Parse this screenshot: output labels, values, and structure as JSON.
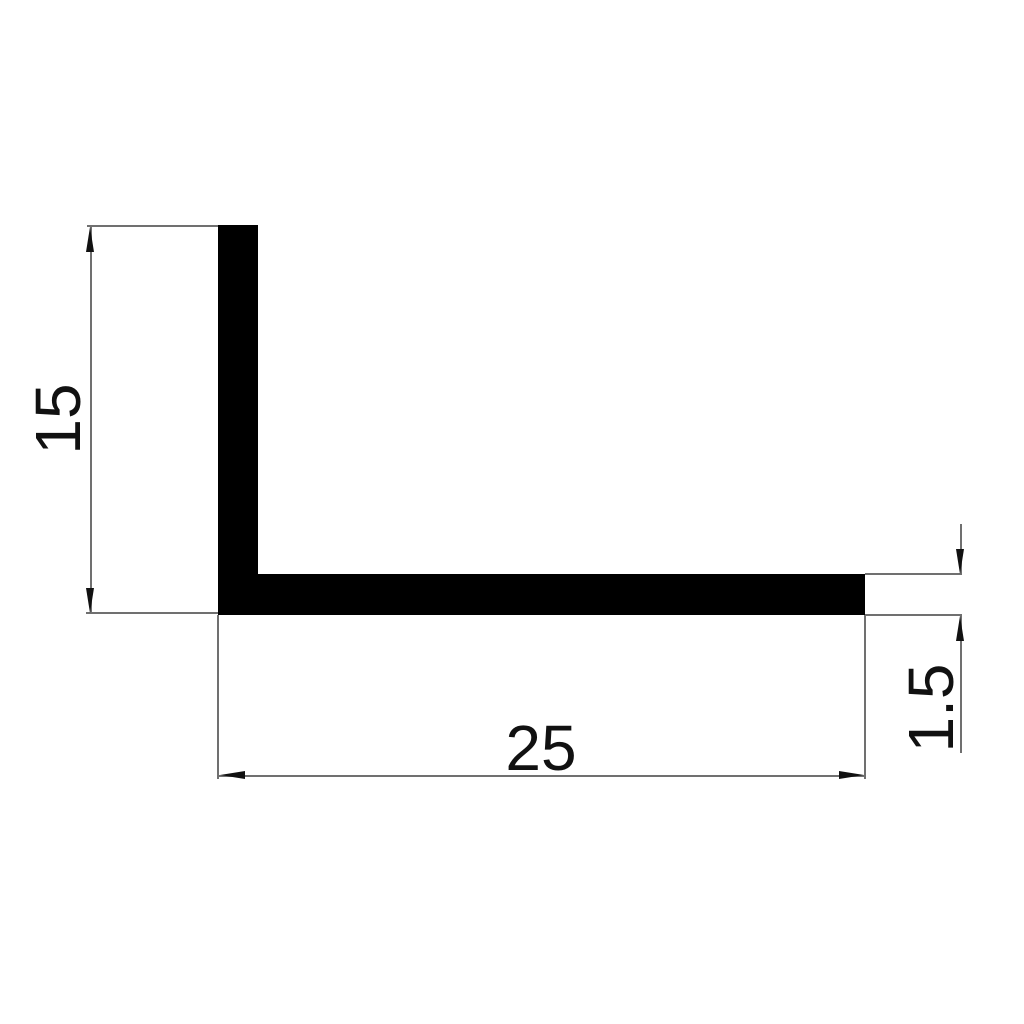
{
  "drawing": {
    "background_color": "#ffffff",
    "profile_color": "#000000",
    "dimension_line_color": "#707070",
    "text_color": "#111111",
    "profile": {
      "shape": "L-angle cross-section"
    },
    "dimensions": {
      "height": {
        "label": "15"
      },
      "width": {
        "label": "25"
      },
      "thickness": {
        "label": "1.5"
      }
    }
  }
}
